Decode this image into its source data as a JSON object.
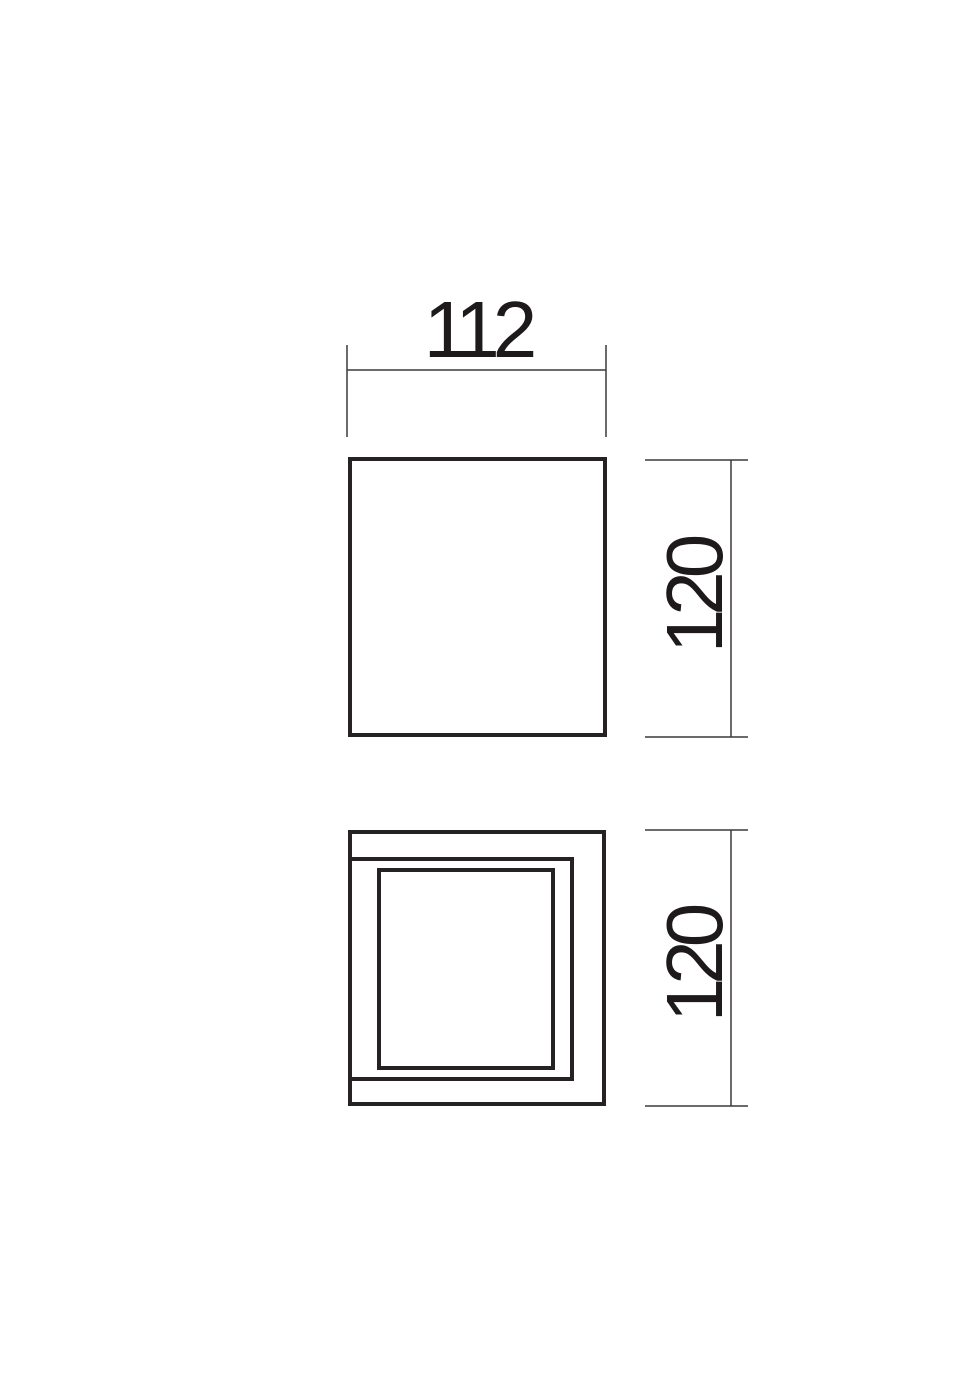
{
  "drawing": {
    "background_color": "#ffffff",
    "outline_color": "#262223",
    "dimension_line_color": "#3d393a",
    "text_color": "#1e1a1b",
    "dimensions": {
      "width_mm": "112",
      "height_mm": "120",
      "depth_mm": "120"
    }
  }
}
